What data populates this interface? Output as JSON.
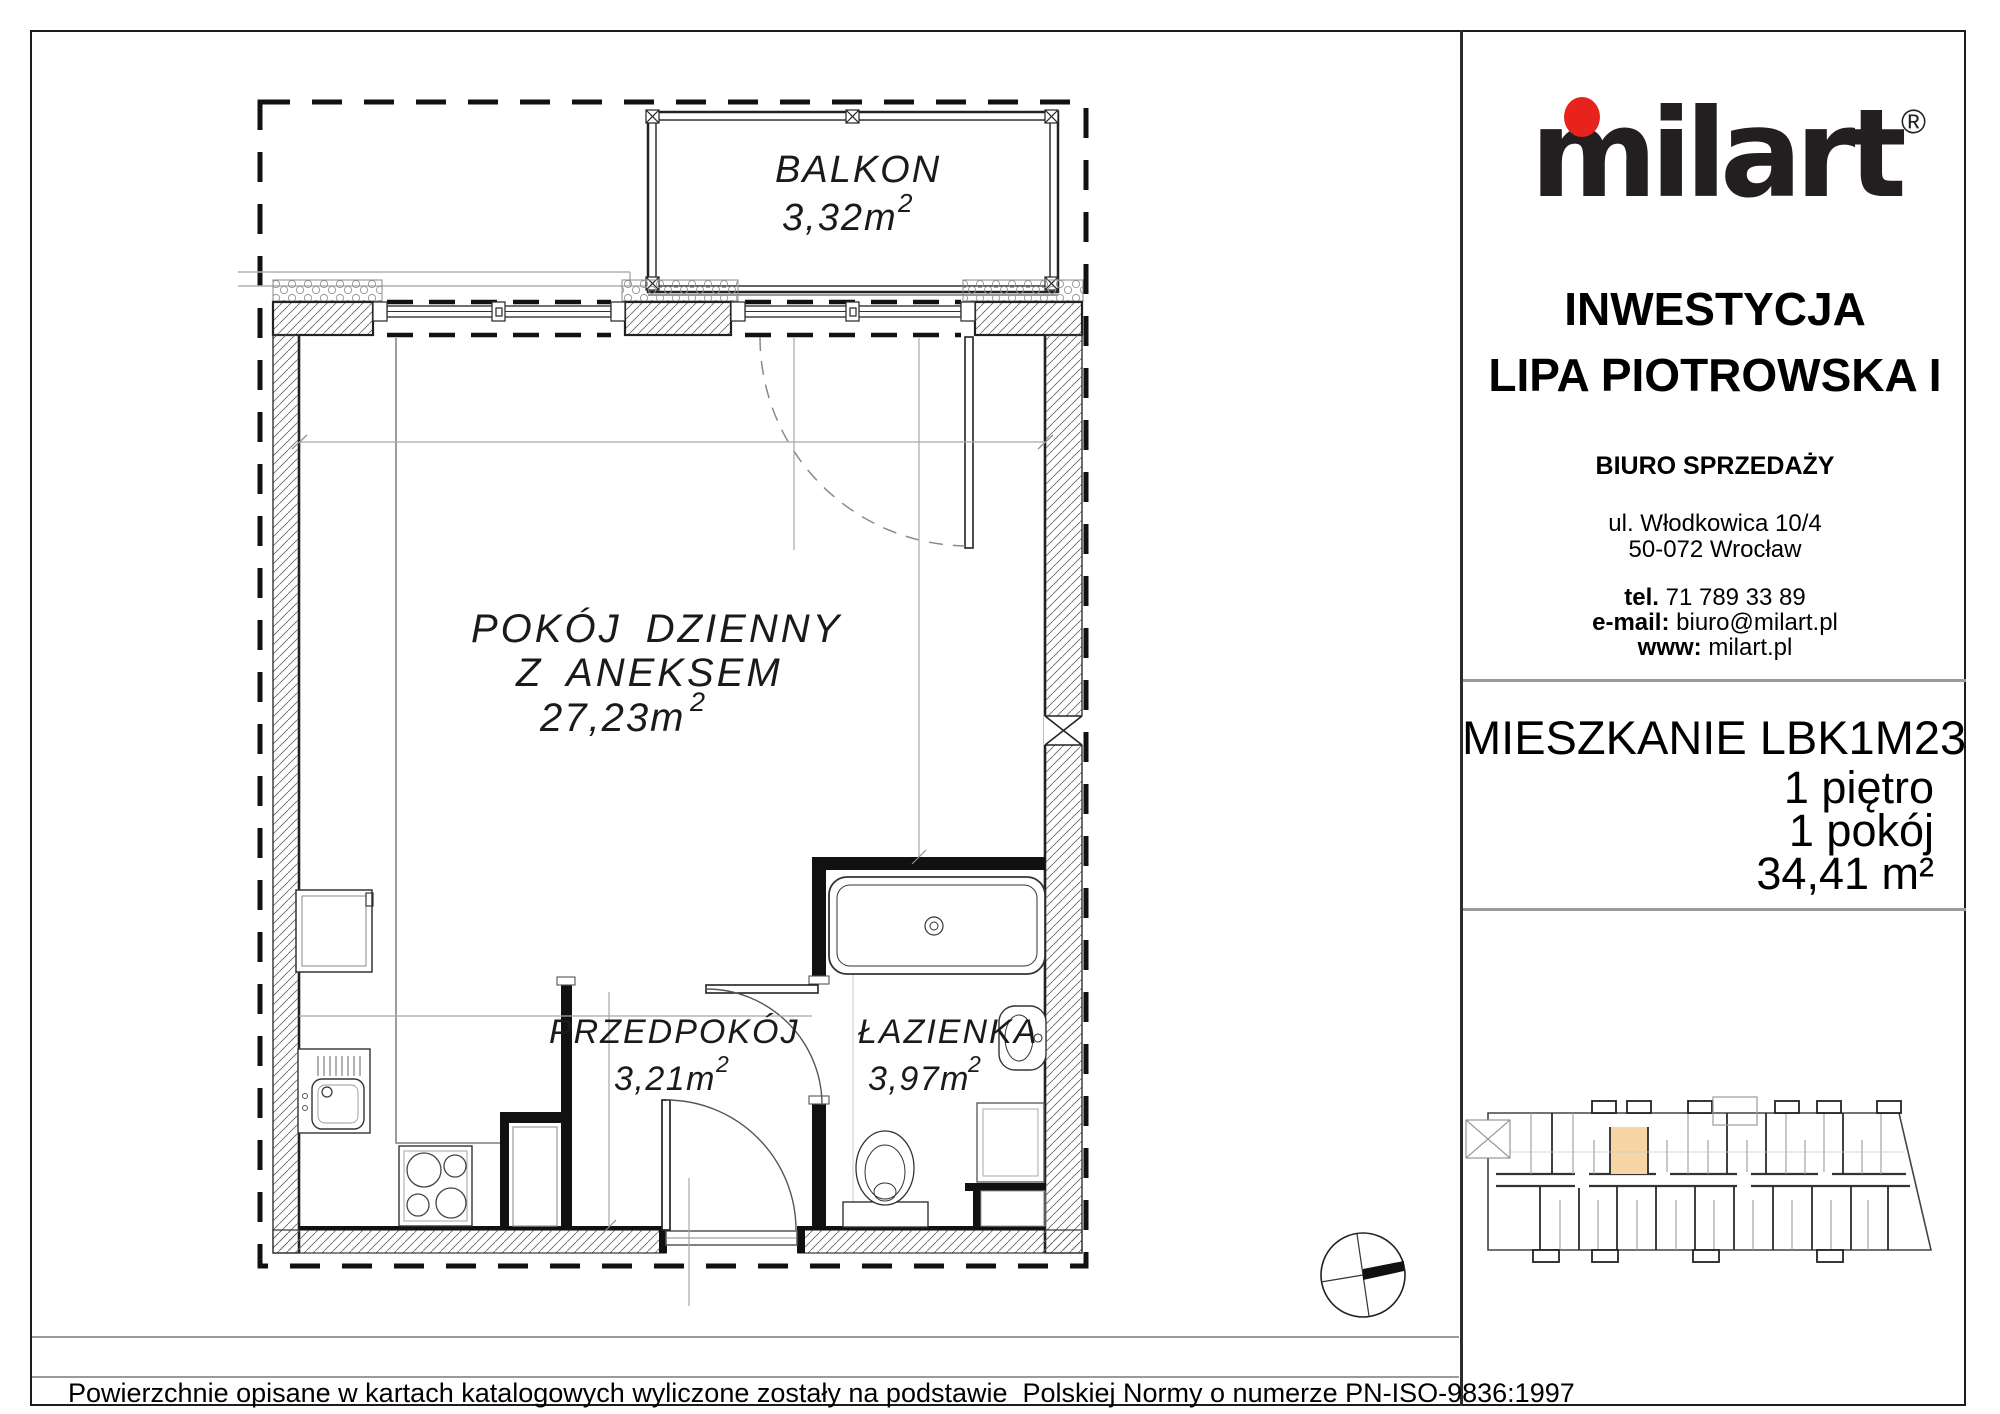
{
  "plan": {
    "rooms": {
      "balkon": {
        "name": "BALKON",
        "area": "3,32m",
        "area_sup": "2"
      },
      "pokoj_dzienny": {
        "name_line1": "POKÓJ DZIENNY",
        "name_line2": "Z ANEKSEM",
        "area": "27,23m",
        "area_sup": "2"
      },
      "przedpokoj": {
        "name": "PRZEDPOKÓJ",
        "area": "3,21m",
        "area_sup": "2"
      },
      "lazienka": {
        "name": "ŁAZIENKA",
        "area": "3,97m",
        "area_sup": "2"
      }
    }
  },
  "sidebar": {
    "logo": {
      "text": "milart",
      "registered": "®",
      "dot_color": "#e8231e",
      "text_color": "#231f20"
    },
    "investment": {
      "label": "INWESTYCJA",
      "name": "LIPA PIOTROWSKA I"
    },
    "sales_office": {
      "title": "BIURO SPRZEDAŻY",
      "address_line1": "ul. Włodkowica 10/4",
      "address_line2": "50-072 Wrocław",
      "phone_label": "tel.",
      "phone": "71 789 33 89",
      "email_label": "e-mail:",
      "email": "biuro@milart.pl",
      "www_label": "www:",
      "www": "milart.pl"
    },
    "apartment": {
      "title": "MIESZKANIE LBK1M23",
      "floor": "1 piętro",
      "rooms": "1 pokój",
      "area": "34,41 m²"
    },
    "minimap": {
      "highlight_color": "#f8d5a4"
    }
  },
  "footer": {
    "note": "Powierzchnie opisane w kartach katalogowych wyliczone zostały na podstawie  Polskiej Normy o numerze PN-ISO-9836:1997"
  }
}
